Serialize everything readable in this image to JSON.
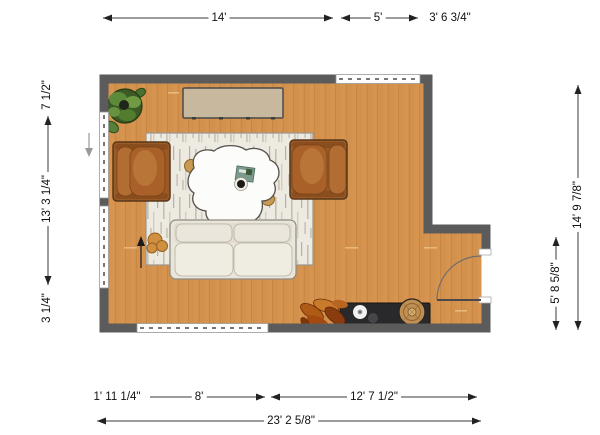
{
  "plan": {
    "title": "living-room-floor-plan",
    "dimensions": {
      "top": [
        "14'",
        "5'",
        "3' 6 3/4\""
      ],
      "left": [
        "7 1/2\"",
        "13' 3 1/4\"",
        "3 1/4\""
      ],
      "right": [
        "14' 9 7/8\"",
        "5' 8 5/8\""
      ],
      "bottom_segments": [
        "1' 11 1/4\"",
        "8'",
        "12' 7 1/2\""
      ],
      "bottom_total": "23' 2 5/8\""
    },
    "colors": {
      "floor": "#d7944f",
      "wall": "#5b5b5b",
      "rug": "#edeae1",
      "armchair": "#a35f28",
      "sofa": "#e9e5da",
      "sideboard": "#c8b89e",
      "media_console": "#29282a",
      "accent_tan": "#c89a52",
      "plant_green": "#5d8a38",
      "plant_rust": "#b05a17"
    },
    "furniture": [
      "potted-plant",
      "sideboard",
      "area-rug",
      "armchair",
      "armchair",
      "coffee-table",
      "sofa",
      "pouf",
      "dried-plant",
      "media-console",
      "round-stool"
    ]
  }
}
